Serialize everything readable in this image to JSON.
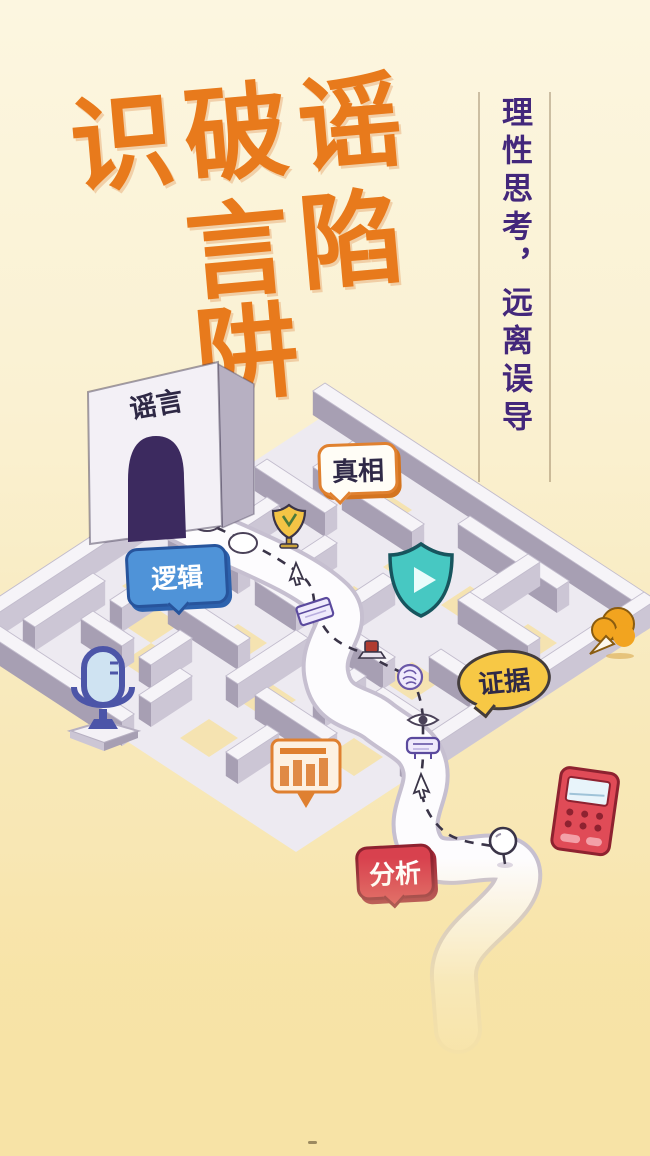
{
  "poster": {
    "title": {
      "line1": "识破谣",
      "line2": "言陷阱",
      "color": "#e87a1c"
    },
    "slogan": {
      "text": "理性思考，远离误导",
      "color": "#43277b"
    },
    "gate": {
      "label": "谣言",
      "arch_color": "#3c2a5f"
    },
    "badges": [
      {
        "id": "truth",
        "label": "真相",
        "bg": "#fffdf6",
        "border": "#e0812f",
        "text_color": "#2f2947"
      },
      {
        "id": "logic",
        "label": "逻辑",
        "bg": "#4f93d8",
        "border": "#27549c",
        "text_color": "#ffffff"
      },
      {
        "id": "evidence",
        "label": "证据",
        "bg": "#f7c845",
        "border": "#433c3c",
        "text_color": "#2f2947"
      },
      {
        "id": "analysis",
        "label": "分析",
        "bg": "#d8414e",
        "border": "#8e2230",
        "text_color": "#ffffff"
      }
    ],
    "icons": [
      {
        "name": "microphone-icon",
        "color": "#4c55a8"
      },
      {
        "name": "shield-play-icon",
        "color": "#47c8c2"
      },
      {
        "name": "bar-chart-icon",
        "color": "#e0812f"
      },
      {
        "name": "megaphone-icon",
        "color": "#f2a41f"
      },
      {
        "name": "calculator-icon",
        "color": "#e04b57"
      },
      {
        "name": "trophy-icon",
        "color": "#f4c445"
      },
      {
        "name": "search-bubble-icon",
        "color": "#ffffff"
      },
      {
        "name": "speech-ellipse-icon",
        "color": "#ffffff"
      },
      {
        "name": "cursor-icon",
        "color": "#ffffff"
      },
      {
        "name": "book-icon",
        "color": "#5b4a9e"
      },
      {
        "name": "stamp-icon",
        "color": "#b03b30"
      },
      {
        "name": "brain-icon",
        "color": "#6a58a8"
      },
      {
        "name": "eye-icon",
        "color": "#4a4158"
      },
      {
        "name": "signboard-icon",
        "color": "#5b4a9e"
      },
      {
        "name": "hand-cursor-icon",
        "color": "#ffffff"
      },
      {
        "name": "magnifier-icon",
        "color": "#3a3448"
      }
    ],
    "colors": {
      "background_top": "#fcf6e0",
      "background_bottom": "#f7e3a6",
      "maze_wall_top": "#f6f4f8",
      "maze_wall_left": "#a79fb3",
      "maze_wall_right": "#ccc6d5",
      "maze_floor": "#edeaf1",
      "floor_patch": "#f6e2a6",
      "path_band": "#fdfcfe",
      "dash_line": "#3a3448"
    }
  }
}
